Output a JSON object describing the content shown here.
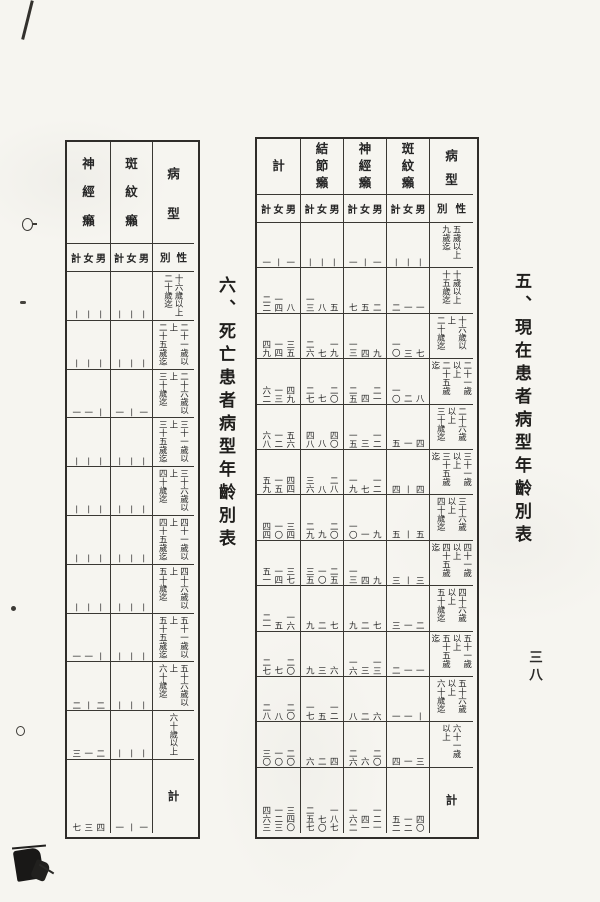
{
  "page_number": "三八",
  "tables": {
    "current": {
      "title": "五、現在患者病型年齡別表",
      "corner_top": "病型",
      "corner_bottom_right": "性",
      "corner_bottom_left": "別",
      "subcol_header": "計女男",
      "columns": [
        "計",
        "結節癩",
        "神經癩",
        "斑紋癩"
      ],
      "total_label": "計",
      "rows": [
        {
          "age": [
            "五歲以上",
            "九歲迄"
          ],
          "cells": [
            [
              "一",
              "丨",
              "一"
            ],
            [
              "丨",
              "丨",
              "丨"
            ],
            [
              "一",
              "丨",
              "一"
            ],
            [
              "丨",
              "丨",
              "丨"
            ]
          ]
        },
        {
          "age": [
            "十歲以上",
            "十五歲迄"
          ],
          "cells": [
            [
              "二二",
              "一四",
              "八"
            ],
            [
              "一三",
              "八",
              "五"
            ],
            [
              "七",
              "五",
              "二"
            ],
            [
              "二",
              "一",
              "一"
            ]
          ]
        },
        {
          "age": [
            "十六歲以上",
            "二十歲迄"
          ],
          "cells": [
            [
              "四九",
              "一四",
              "三五"
            ],
            [
              "二六",
              "七",
              "一九"
            ],
            [
              "一三",
              "四",
              "九"
            ],
            [
              "一〇",
              "三",
              "七"
            ]
          ]
        },
        {
          "age": [
            "二十一歲以上",
            "二十五歲迄"
          ],
          "cells": [
            [
              "六二",
              "一三",
              "四九"
            ],
            [
              "二七",
              "七",
              "二〇"
            ],
            [
              "二五",
              "四",
              "二一"
            ],
            [
              "一〇",
              "二",
              "八"
            ]
          ]
        },
        {
          "age": [
            "二十六歲以上",
            "三十歲迄"
          ],
          "cells": [
            [
              "六八",
              "一二",
              "五六"
            ],
            [
              "四八",
              "八",
              "四〇"
            ],
            [
              "一五",
              "三",
              "一二"
            ],
            [
              "五",
              "一",
              "四"
            ]
          ]
        },
        {
          "age": [
            "三十一歲以上",
            "三十五歲迄"
          ],
          "cells": [
            [
              "五九",
              "一五",
              "四四"
            ],
            [
              "三六",
              "八",
              "二八"
            ],
            [
              "一九",
              "七",
              "一二"
            ],
            [
              "四",
              "丨",
              "四"
            ]
          ]
        },
        {
          "age": [
            "三十六歲以上",
            "四十歲迄"
          ],
          "cells": [
            [
              "四四",
              "一〇",
              "三四"
            ],
            [
              "二九",
              "九",
              "二〇"
            ],
            [
              "一〇",
              "一",
              "九"
            ],
            [
              "五",
              "丨",
              "五"
            ]
          ]
        },
        {
          "age": [
            "四十一歲以上",
            "四十五歲迄"
          ],
          "cells": [
            [
              "五一",
              "一四",
              "三七"
            ],
            [
              "三五",
              "一〇",
              "二五"
            ],
            [
              "一三",
              "四",
              "九"
            ],
            [
              "三",
              "丨",
              "三"
            ]
          ]
        },
        {
          "age": [
            "四十六歲以上",
            "五十歲迄"
          ],
          "cells": [
            [
              "二一",
              "五",
              "一六"
            ],
            [
              "九",
              "二",
              "七"
            ],
            [
              "九",
              "二",
              "七"
            ],
            [
              "三",
              "一",
              "二"
            ]
          ]
        },
        {
          "age": [
            "五十一歲以上",
            "五十五歲迄"
          ],
          "cells": [
            [
              "二七",
              "七",
              "二〇"
            ],
            [
              "九",
              "三",
              "六"
            ],
            [
              "一六",
              "三",
              "一三"
            ],
            [
              "二",
              "一",
              "一"
            ]
          ]
        },
        {
          "age": [
            "五十六歲以上",
            "六十歲迄"
          ],
          "cells": [
            [
              "二八",
              "八",
              "二〇"
            ],
            [
              "一七",
              "五",
              "一二"
            ],
            [
              "八",
              "二",
              "六"
            ],
            [
              "一",
              "一",
              "丨"
            ]
          ]
        },
        {
          "age": [
            "六十一歲以上"
          ],
          "cells": [
            [
              "三〇",
              "一〇",
              "二〇"
            ],
            [
              "六",
              "二",
              "四"
            ],
            [
              "二六",
              "六",
              "二〇"
            ],
            [
              "四",
              "一",
              "三"
            ]
          ]
        }
      ],
      "total_cells": [
        [
          "四六三",
          "一二三",
          "三四〇"
        ],
        [
          "二五七",
          "七〇",
          "一八七"
        ],
        [
          "一六二",
          "四一",
          "一二一"
        ],
        [
          "五二",
          "一二",
          "四〇"
        ]
      ]
    },
    "death": {
      "title": "六、死亡患者病型年齡別表",
      "corner_top": "病型",
      "corner_bottom_right": "性",
      "corner_bottom_left": "別",
      "subcol_header": "計女男",
      "columns": [
        "神經癩",
        "斑紋癩"
      ],
      "total_label": "計",
      "rows": [
        {
          "age": [
            "十六歲以上",
            "二十歲迄"
          ],
          "cells": [
            [
              "丨",
              "丨",
              "丨"
            ],
            [
              "丨",
              "丨",
              "丨"
            ]
          ]
        },
        {
          "age": [
            "二十一歲以上",
            "二十五歲迄"
          ],
          "cells": [
            [
              "丨",
              "丨",
              "丨"
            ],
            [
              "丨",
              "丨",
              "丨"
            ]
          ]
        },
        {
          "age": [
            "二十六歲以上",
            "三十歲迄"
          ],
          "cells": [
            [
              "一",
              "一",
              "丨"
            ],
            [
              "一",
              "丨",
              "一"
            ]
          ]
        },
        {
          "age": [
            "三十一歲以上",
            "三十五歲迄"
          ],
          "cells": [
            [
              "丨",
              "丨",
              "丨"
            ],
            [
              "丨",
              "丨",
              "丨"
            ]
          ]
        },
        {
          "age": [
            "三十六歲以上",
            "四十歲迄"
          ],
          "cells": [
            [
              "丨",
              "丨",
              "丨"
            ],
            [
              "丨",
              "丨",
              "丨"
            ]
          ]
        },
        {
          "age": [
            "四十一歲以上",
            "四十五歲迄"
          ],
          "cells": [
            [
              "丨",
              "丨",
              "丨"
            ],
            [
              "丨",
              "丨",
              "丨"
            ]
          ]
        },
        {
          "age": [
            "四十六歲以上",
            "五十歲迄"
          ],
          "cells": [
            [
              "丨",
              "丨",
              "丨"
            ],
            [
              "丨",
              "丨",
              "丨"
            ]
          ]
        },
        {
          "age": [
            "五十一歲以上",
            "五十五歲迄"
          ],
          "cells": [
            [
              "一",
              "一",
              "丨"
            ],
            [
              "丨",
              "丨",
              "丨"
            ]
          ]
        },
        {
          "age": [
            "五十六歲以上",
            "六十歲迄"
          ],
          "cells": [
            [
              "二",
              "丨",
              "二"
            ],
            [
              "丨",
              "丨",
              "丨"
            ]
          ]
        },
        {
          "age": [
            "六十歲以上"
          ],
          "cells": [
            [
              "三",
              "一",
              "二"
            ],
            [
              "丨",
              "丨",
              "丨"
            ]
          ]
        }
      ],
      "total_cells": [
        [
          "七",
          "三",
          "四"
        ],
        [
          "一",
          "丨",
          "一"
        ]
      ]
    }
  }
}
